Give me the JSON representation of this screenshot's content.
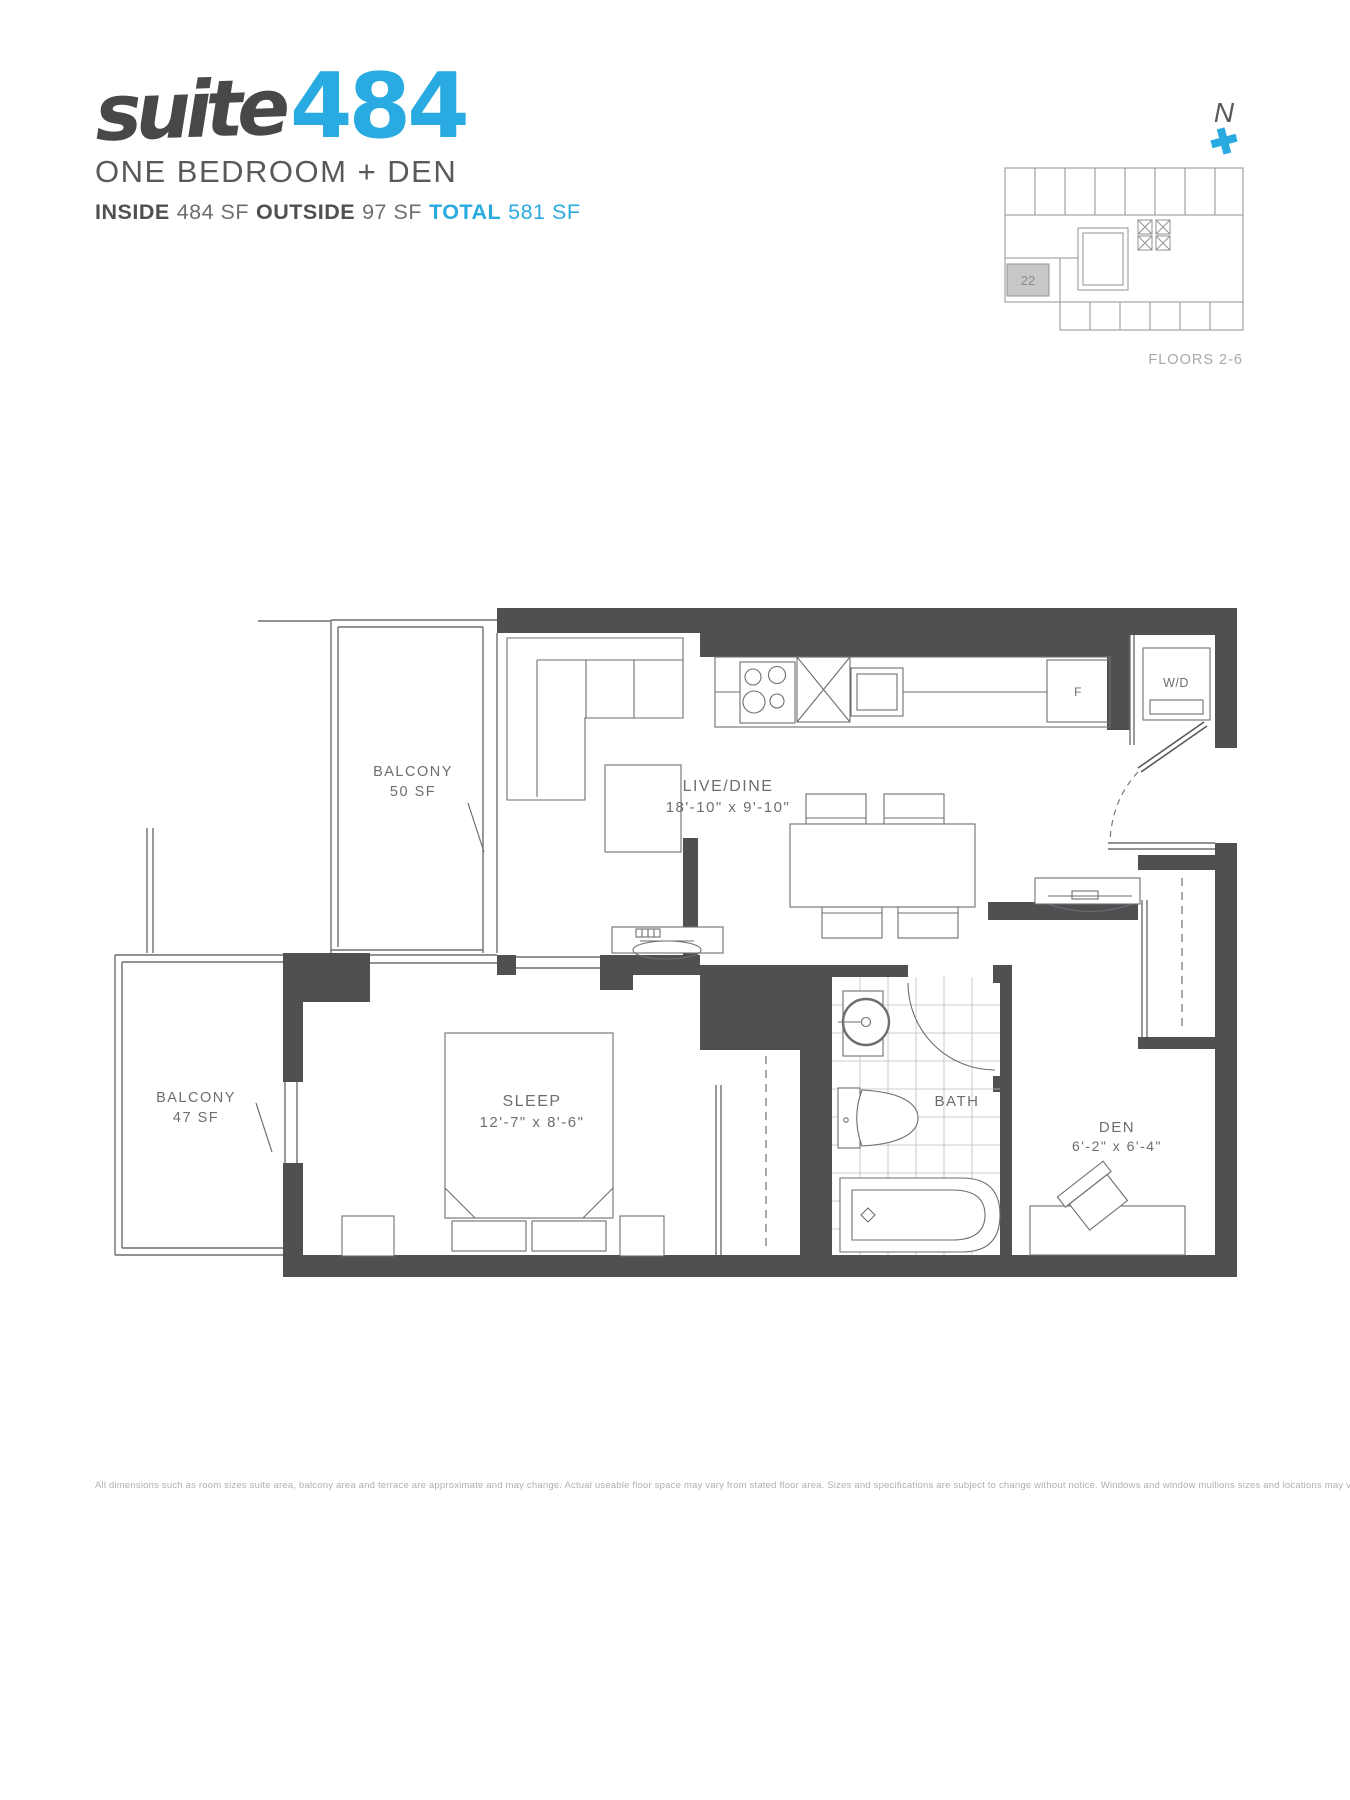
{
  "header": {
    "logo_script": "suite",
    "logo_number": "484",
    "subtitle": "ONE BEDROOM + DEN",
    "inside_label": "INSIDE",
    "inside_value": "484 SF",
    "outside_label": "OUTSIDE",
    "outside_value": "97 SF",
    "total_label": "TOTAL",
    "total_value": "581 SF"
  },
  "keyplan": {
    "north_label": "N",
    "unit_number": "22",
    "floors_label": "FLOORS 2-6"
  },
  "floorplan": {
    "balcony_upper": {
      "label": "BALCONY",
      "area": "50 SF"
    },
    "balcony_lower": {
      "label": "BALCONY",
      "area": "47 SF"
    },
    "live_dine": {
      "label": "LIVE/DINE",
      "dims": "18'-10\" x 9'-10\""
    },
    "sleep": {
      "label": "SLEEP",
      "dims": "12'-7\" x 8'-6\""
    },
    "bath": {
      "label": "BATH"
    },
    "den": {
      "label": "DEN",
      "dims": "6'-2\" x 6'-4\""
    },
    "washer_dryer": "W/D",
    "fridge": "F"
  },
  "footer": {
    "disclaimer": "All dimensions such as room sizes suite area, balcony area and terrace are approximate and may change. Actual useable floor space may vary from stated floor area. Sizes and specifications are subject to change without notice. Windows and window mullions sizes and locations may vary. E. & O. E."
  },
  "colors": {
    "accent": "#29abe2",
    "wall": "#4f5052",
    "line": "#6d6e71",
    "muted": "#a7a9ac"
  }
}
